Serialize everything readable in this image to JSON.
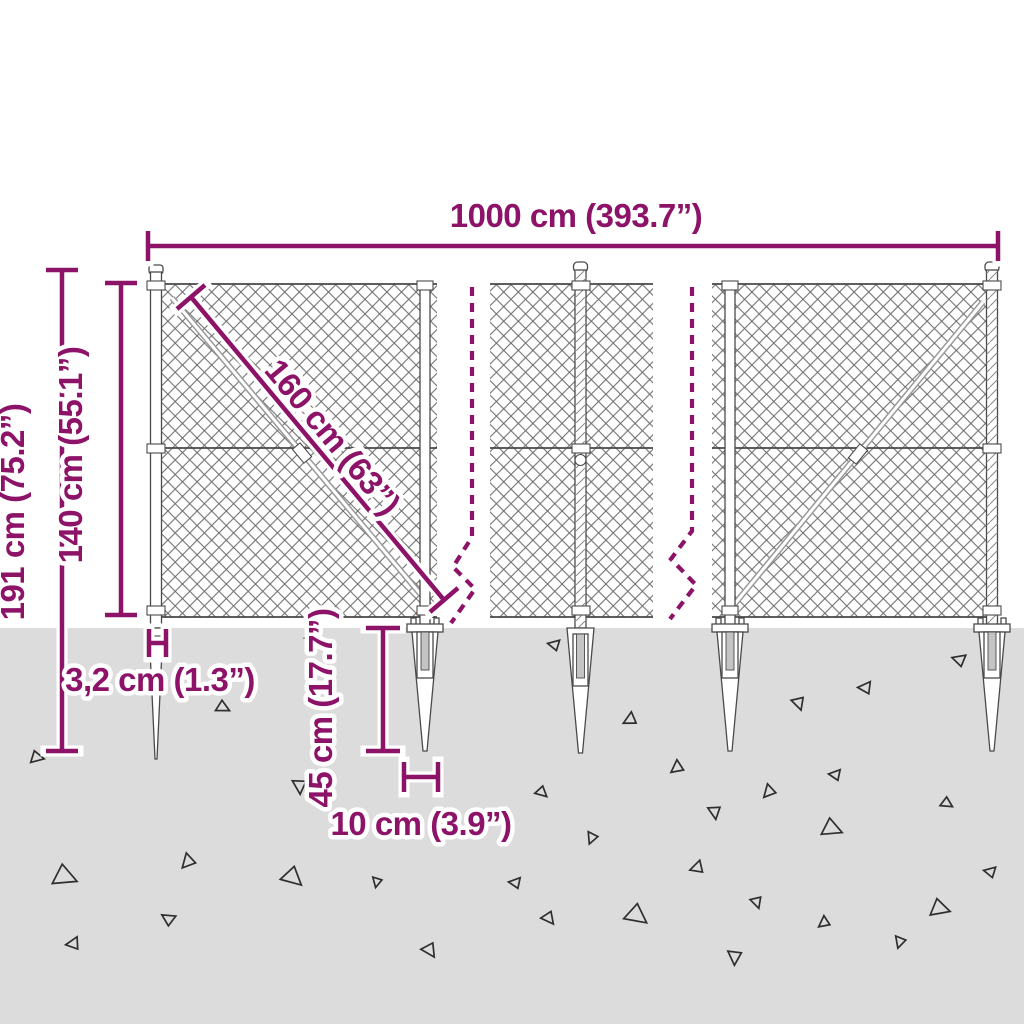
{
  "diagram": {
    "kind": "chain-link fence with spike anchors — dimension diagram",
    "colors": {
      "dimension_accent": "#8D1368",
      "ground": "#DCDCDC",
      "mesh_line": "#6E6E6E"
    },
    "dimensions": {
      "total_width": "1000 cm (393.7”)",
      "total_height": "191 cm (75.2”)",
      "fence_height": "140 cm (55.1”)",
      "mesh_diagonal": "160 cm (63”)",
      "post_thickness": "3,2 cm (1.3”)",
      "spike_depth": "45 cm (17.7”)",
      "spike_width": "10 cm (3.9”)"
    },
    "structure": {
      "panel_count": 3,
      "post_count": 5,
      "spike_anchor_count": 5
    }
  }
}
